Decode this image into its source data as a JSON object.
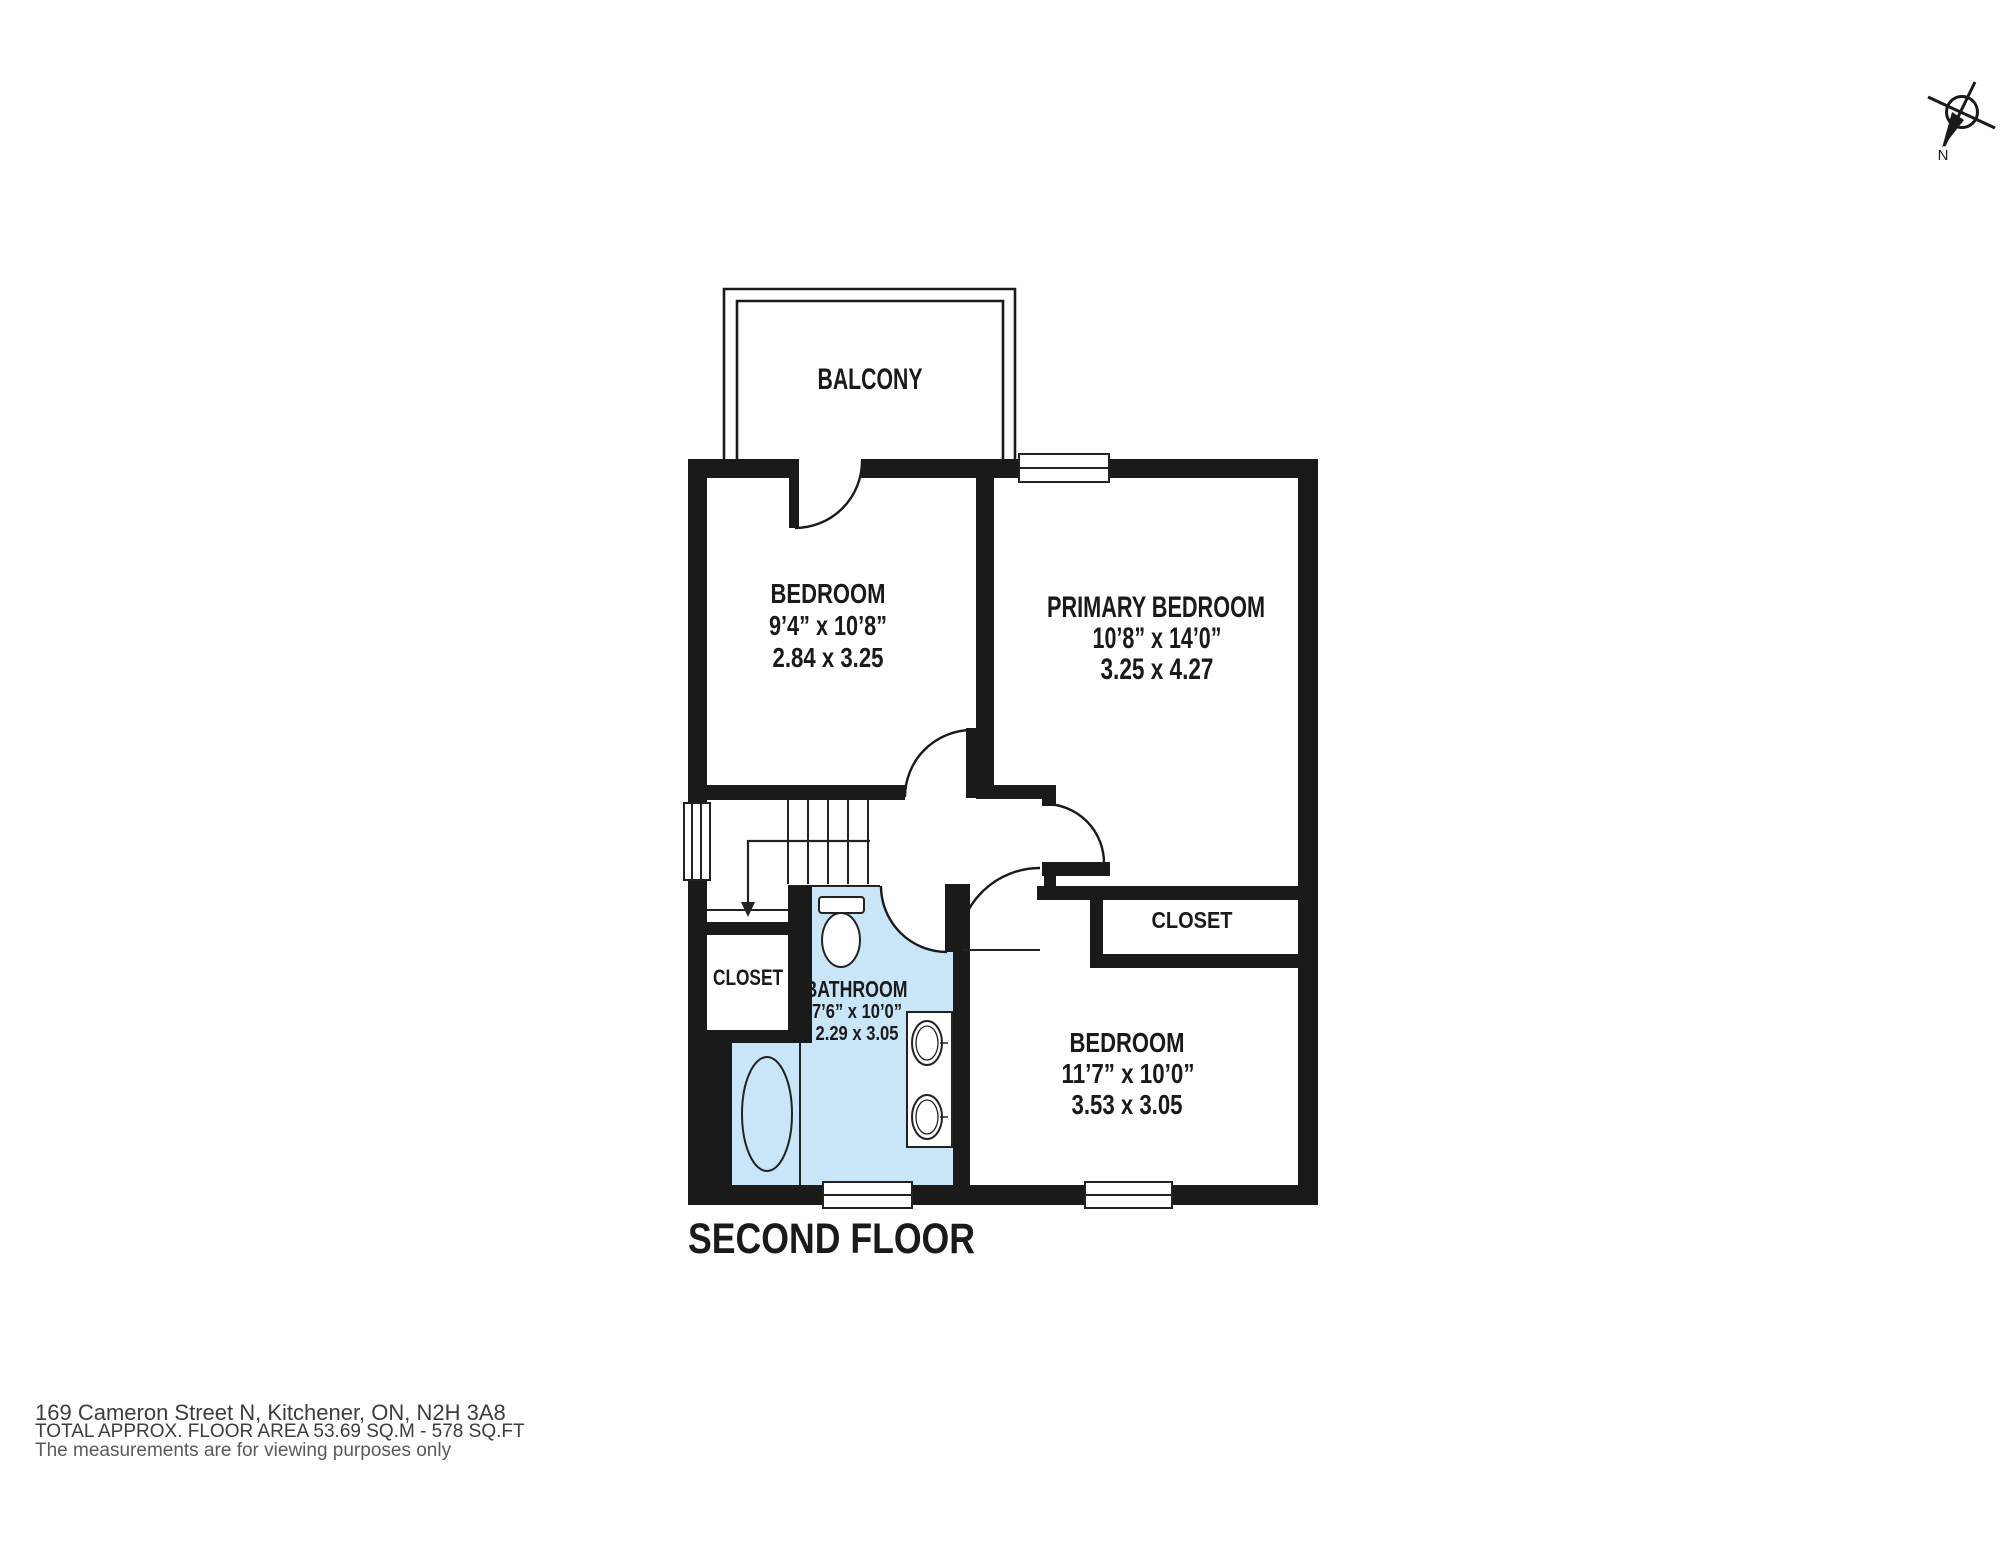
{
  "title": "SECOND FLOOR",
  "compass": {
    "north_label": "N"
  },
  "colors": {
    "wall": "#1a1a1a",
    "wet_area": "#c8e6f7",
    "thin_line": "#222222"
  },
  "rooms": {
    "balcony": {
      "label": "BALCONY"
    },
    "bedroom_top": {
      "label": "BEDROOM",
      "imperial": "9’4” x 10’8”",
      "metric": "2.84 x 3.25"
    },
    "primary_bedroom": {
      "label": "PRIMARY BEDROOM",
      "imperial": "10’8” x 14’0”",
      "metric": "3.25 x 4.27"
    },
    "primary_closet": {
      "label": "CLOSET"
    },
    "hall_closet": {
      "label": "CLOSET"
    },
    "bathroom": {
      "label": "BATHROOM",
      "imperial": "7’6” x 10’0”",
      "metric": "2.29 x 3.05"
    },
    "bedroom_bottom": {
      "label": "BEDROOM",
      "imperial": "11’7” x 10’0”",
      "metric": "3.53 x 3.05"
    }
  },
  "footer": {
    "address": "169 Cameron Street N, Kitchener, ON, N2H 3A8",
    "area": "TOTAL APPROX. FLOOR AREA 53.69 SQ.M - 578 SQ.FT",
    "disclaimer": "The measurements are for viewing purposes only"
  }
}
